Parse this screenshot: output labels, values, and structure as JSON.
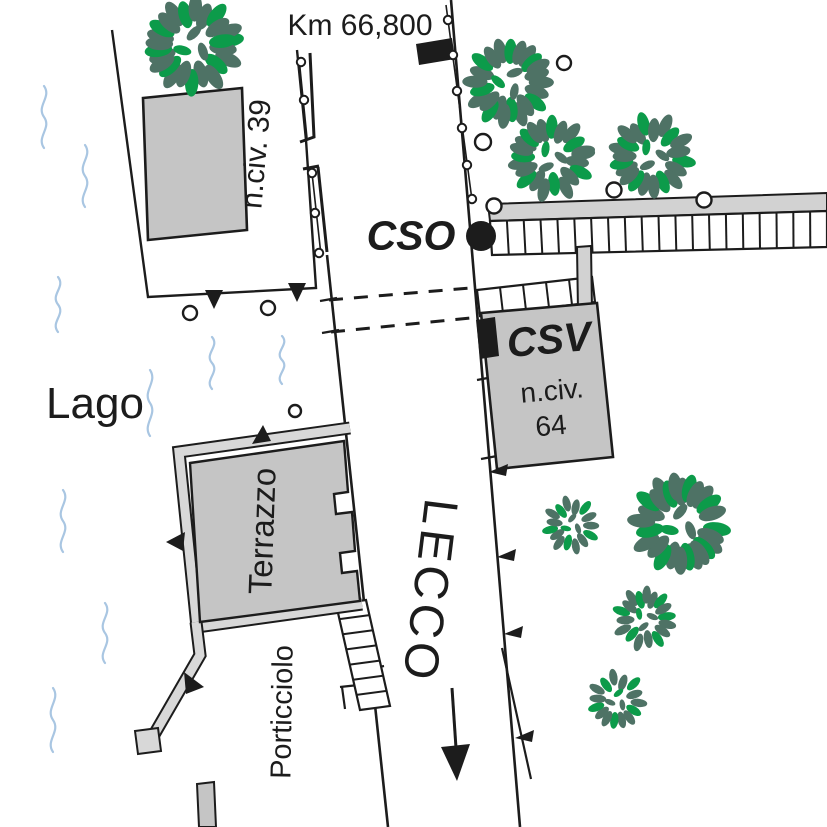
{
  "labels": {
    "km": "Km 66,800",
    "lago": "Lago",
    "cso": "CSO",
    "csv": "CSV",
    "nciv39": "n.civ. 39",
    "nciv64_line1": "n.civ.",
    "nciv64_line2": "64",
    "terrazzo": "Terrazzo",
    "porticciolo": "Porticciolo",
    "lecco": "LECCO"
  },
  "colors": {
    "outline": "#1c1c1c",
    "building_gray": "#c5c5c5",
    "wall_gray": "#d8d8d8",
    "band_gray": "#d2d2d2",
    "water_blue": "#a9c6e2",
    "leaf_dark": "#4e7265",
    "leaf_green": "#0c9b4a",
    "marker_black": "#111111"
  },
  "trees": [
    {
      "cx": 193,
      "cy": 45,
      "r": 46
    },
    {
      "cx": 509,
      "cy": 82,
      "r": 42
    },
    {
      "cx": 551,
      "cy": 158,
      "r": 40
    },
    {
      "cx": 652,
      "cy": 156,
      "r": 40
    },
    {
      "cx": 572,
      "cy": 525,
      "r": 27
    },
    {
      "cx": 680,
      "cy": 524,
      "r": 47
    },
    {
      "cx": 645,
      "cy": 619,
      "r": 30
    },
    {
      "cx": 617,
      "cy": 700,
      "r": 28
    }
  ],
  "bollards": [
    [
      564,
      63,
      7
    ],
    [
      483,
      142,
      8
    ],
    [
      614,
      190,
      7.5
    ],
    [
      704,
      200,
      7.5
    ],
    [
      494,
      206,
      7.5
    ],
    [
      268,
      308,
      7
    ],
    [
      190,
      313,
      7
    ],
    [
      295,
      411,
      6
    ]
  ],
  "fence_posts": [
    [
      301,
      62
    ],
    [
      304,
      100
    ],
    [
      312,
      173
    ],
    [
      315,
      213
    ],
    [
      319,
      253
    ],
    [
      448,
      20
    ],
    [
      453,
      55
    ],
    [
      457,
      91
    ],
    [
      462,
      128
    ],
    [
      467,
      165
    ],
    [
      472,
      199
    ]
  ],
  "waves": [
    {
      "x": 44,
      "y": 86,
      "len": 62
    },
    {
      "x": 85,
      "y": 145,
      "len": 62
    },
    {
      "x": 58,
      "y": 277,
      "len": 55
    },
    {
      "x": 150,
      "y": 370,
      "len": 66
    },
    {
      "x": 212,
      "y": 337,
      "len": 52
    },
    {
      "x": 282,
      "y": 336,
      "len": 48
    },
    {
      "x": 63,
      "y": 490,
      "len": 62
    },
    {
      "x": 105,
      "y": 603,
      "len": 60
    },
    {
      "x": 53,
      "y": 688,
      "len": 64
    }
  ],
  "road_flags": [
    {
      "x": 489,
      "y": 472
    },
    {
      "x": 497,
      "y": 557
    },
    {
      "x": 504,
      "y": 634
    },
    {
      "x": 515,
      "y": 738
    }
  ],
  "ladders": [
    {
      "name": "boardwalk-ladder",
      "corners": [
        [
          490,
          221
        ],
        [
          492,
          255
        ],
        [
          827,
          247
        ],
        [
          827,
          211
        ]
      ],
      "rungs": 19
    },
    {
      "name": "csv-steps-ladder",
      "corners": [
        [
          477,
          290
        ],
        [
          480,
          316
        ],
        [
          595,
          302
        ],
        [
          592,
          277
        ]
      ],
      "rungs": 4
    },
    {
      "name": "terrace-stairs-ladder",
      "corners": [
        [
          336,
          604
        ],
        [
          366,
          600
        ],
        [
          390,
          706
        ],
        [
          360,
          710
        ]
      ],
      "rungs": 6
    }
  ]
}
